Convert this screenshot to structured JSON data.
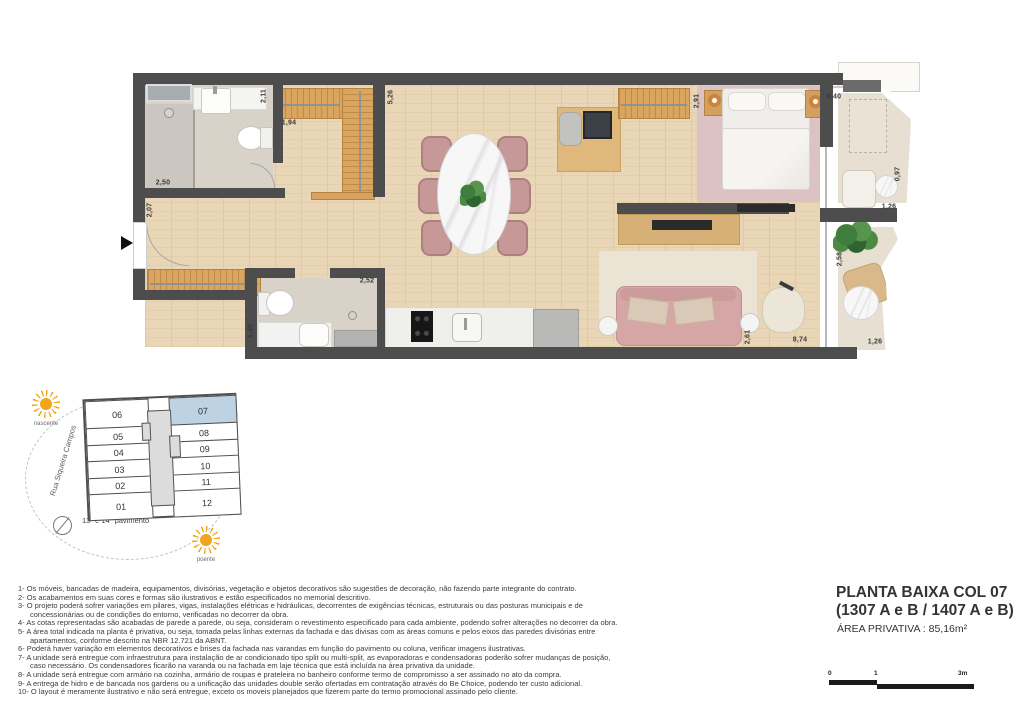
{
  "title_block": {
    "line1": "PLANTA BAIXA COL 07",
    "line2": "(1307 A e B / 1407 A e B)",
    "line3": "ÁREA PRIVATIVA : 85,16m²",
    "scale": {
      "t0": "0",
      "t1": "1",
      "t2": "3m"
    }
  },
  "plan": {
    "dims": [
      "2,11",
      "1,94",
      "5,26",
      "2,50",
      "2,07",
      "2,52",
      "1,45",
      "2,91",
      "9,40",
      "0,97",
      "1,26",
      "2,58",
      "1,26",
      "2,61",
      "8,74"
    ]
  },
  "keyplan": {
    "street": "Rua Siqueira Campos",
    "caption": "13º e 14º pavimento",
    "sun_east": "nascente",
    "sun_west": "poente",
    "left_units": [
      "06",
      "05",
      "04",
      "03",
      "02",
      "01"
    ],
    "right_units": [
      "07",
      "08",
      "09",
      "10",
      "11",
      "12"
    ],
    "highlighted_unit": "07",
    "highlight_color": "#bdd2e2"
  },
  "notes": {
    "lines": [
      "1- Os móveis, bancadas de madeira, equipamentos, divisórias, vegetação e objetos decorativos são sugestões de decoração, não fazendo parte integrante do contrato.",
      "2- Os acabamentos em suas cores e formas são ilustrativos e estão especificados no memorial descritivo.",
      "3- O projeto poderá sofrer variações em pilares, vigas, instalações elétricas e hidráulicas, decorrentes de exigências técnicas, estruturais ou das posturas municipais e de concessionárias ou de condições do entorno, verificadas no decorrer da obra.",
      "4- As cotas representadas são acabadas de parede a parede, ou seja, consideram o revestimento especificado para cada ambiente, podendo sofrer alterações no decorrer da obra.",
      "5- A área total indicada na planta é privativa, ou seja, tomada pelas linhas externas da fachada e das divisas com as áreas comuns e pelos eixos das paredes divisórias entre apartamentos, conforme descrito na NBR 12.721 da ABNT.",
      "6- Poderá haver variação em elementos decorativos e brises da fachada nas varandas em função do pavimento ou coluna, verificar imagens ilustrativas.",
      "7- A unidade será entregue com infraestrutura para instalação de ar condicionado tipo split ou multi-split, as evaporadoras e condensadoras poderão sofrer mudanças de posição, caso necessário. Os condensadores ficarão na varanda ou na fachada em laje técnica que está incluída na área privativa da unidade.",
      "8- A unidade será entregue com armário na cozinha, armário de roupas e prateleira no banheiro conforme termo de compromisso a ser assinado no ato da compra.",
      "9- A entrega de hidro e de bancada nos gardens ou a unificação das unidades double serão ofertadas em contratação através do Be Choice, podendo ter custo adicional.",
      "10- O layout é meramente ilustrativo e não será entregue, exceto os moveis planejados que fizerem parte do termo promocional assinado pelo cliente."
    ]
  }
}
